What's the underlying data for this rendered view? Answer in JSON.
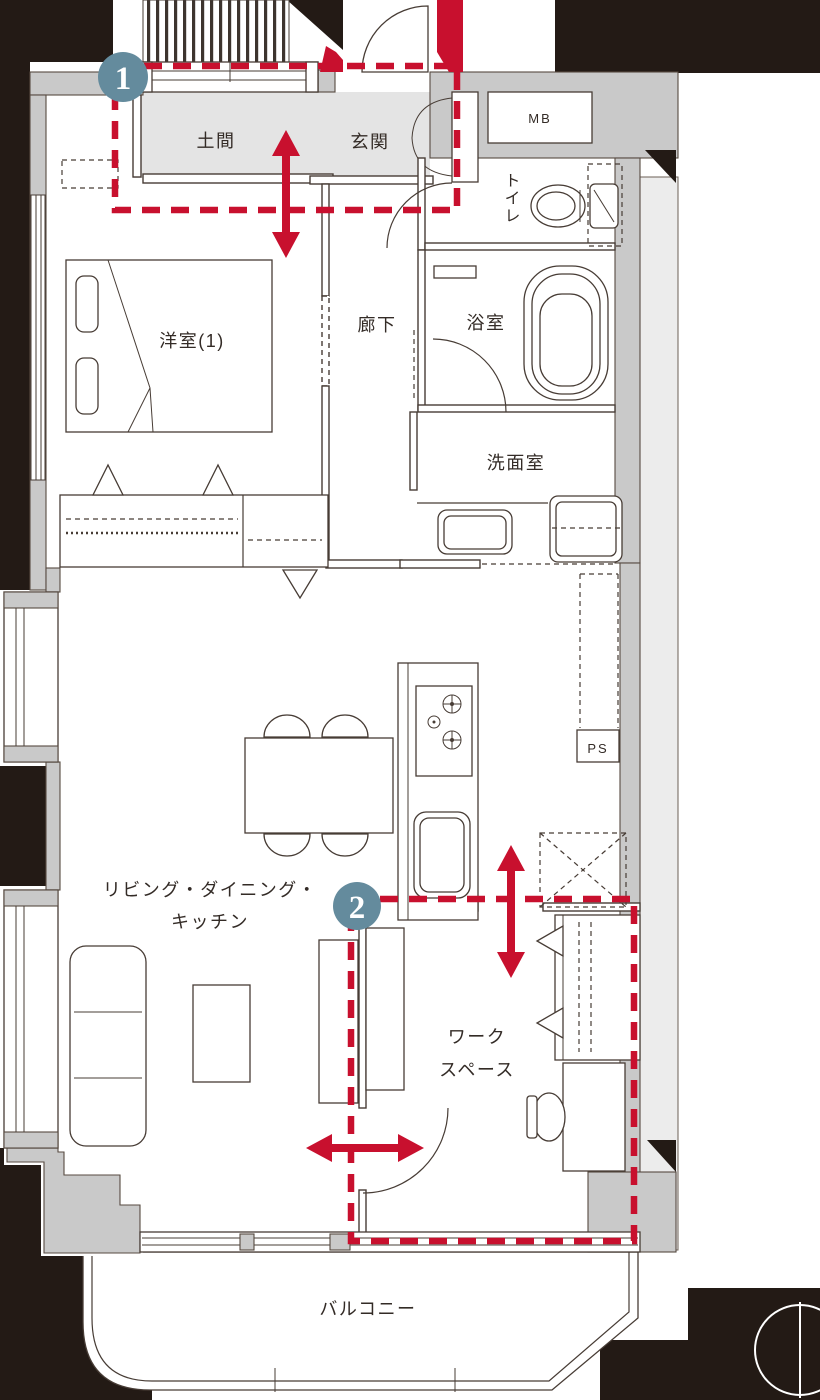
{
  "plan": {
    "rooms": {
      "doma": "土間",
      "genkan": "玄関",
      "toilet": "トイレ",
      "bath": "浴室",
      "washroom": "洗面室",
      "corridor": "廊下",
      "bedroom": "洋室(1)",
      "ldk_line1": "リビング・ダイニング・",
      "ldk_line2": "キッチン",
      "workspace_line1": "ワーク",
      "workspace_line2": "スペース",
      "balcony": "バルコニー"
    },
    "service_boxes": {
      "mb": "MB",
      "ps": "PS"
    },
    "markers": {
      "m1": "1",
      "m2": "2"
    },
    "colors": {
      "highlight_red": "#c8102e",
      "marker_blue": "#648b9d",
      "wall_gray": "#c9c9c9",
      "entrance_floor_gray": "#e4e4e4",
      "exterior_black": "#231a15"
    }
  }
}
